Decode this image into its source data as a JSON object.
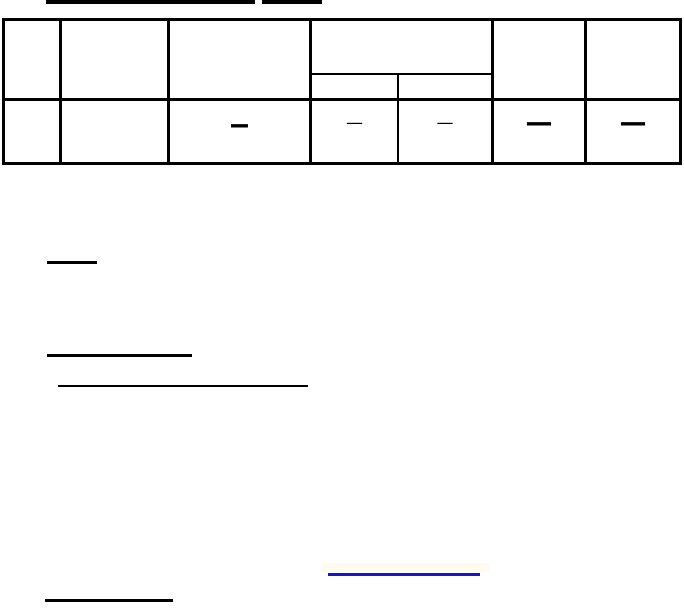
{
  "document": {
    "background": "#ffffff",
    "rule_color": "#000000",
    "link_color": "#1414cc",
    "highlight_color": "#fffbe8"
  },
  "table": {
    "header_row": [
      "",
      "",
      "",
      "",
      "",
      "",
      ""
    ],
    "sub_header_row": [
      "",
      ""
    ],
    "data_row": [
      "",
      "",
      "—",
      "—",
      "—",
      "—",
      "—"
    ]
  }
}
